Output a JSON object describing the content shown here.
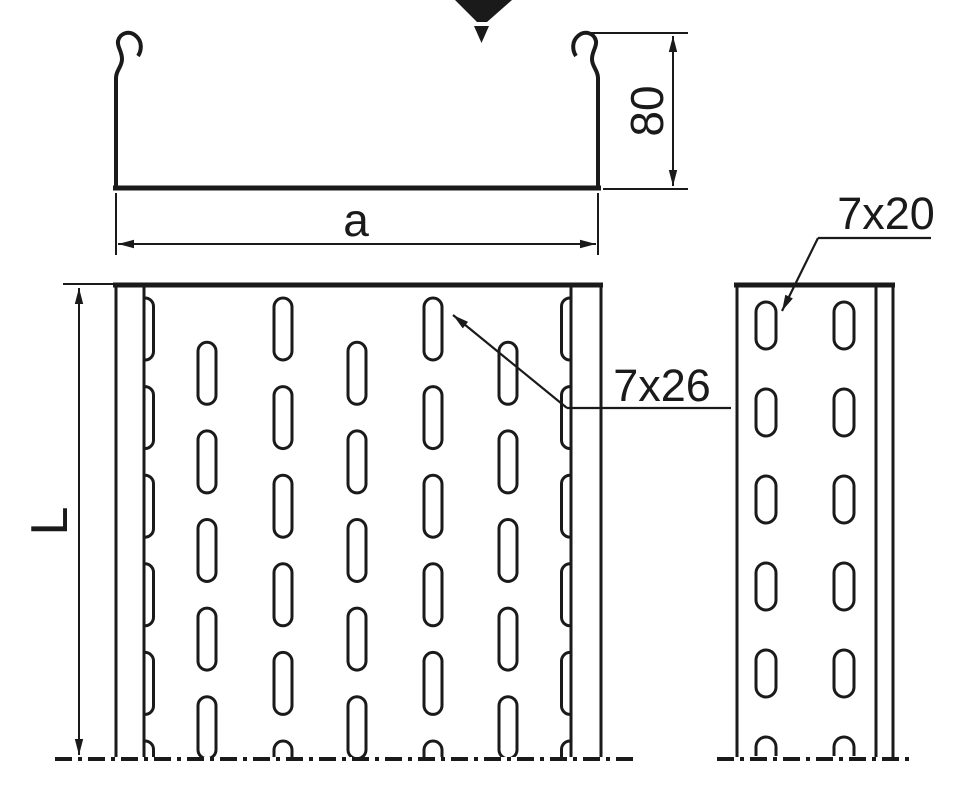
{
  "drawing": {
    "labels": {
      "profile_height": "80",
      "profile_width": "a",
      "tray_length": "L",
      "plan_slot_size": "7x26",
      "side_slot_size": "7x20"
    },
    "colors": {
      "line": "#1a1a1a",
      "background": "#ffffff"
    }
  }
}
